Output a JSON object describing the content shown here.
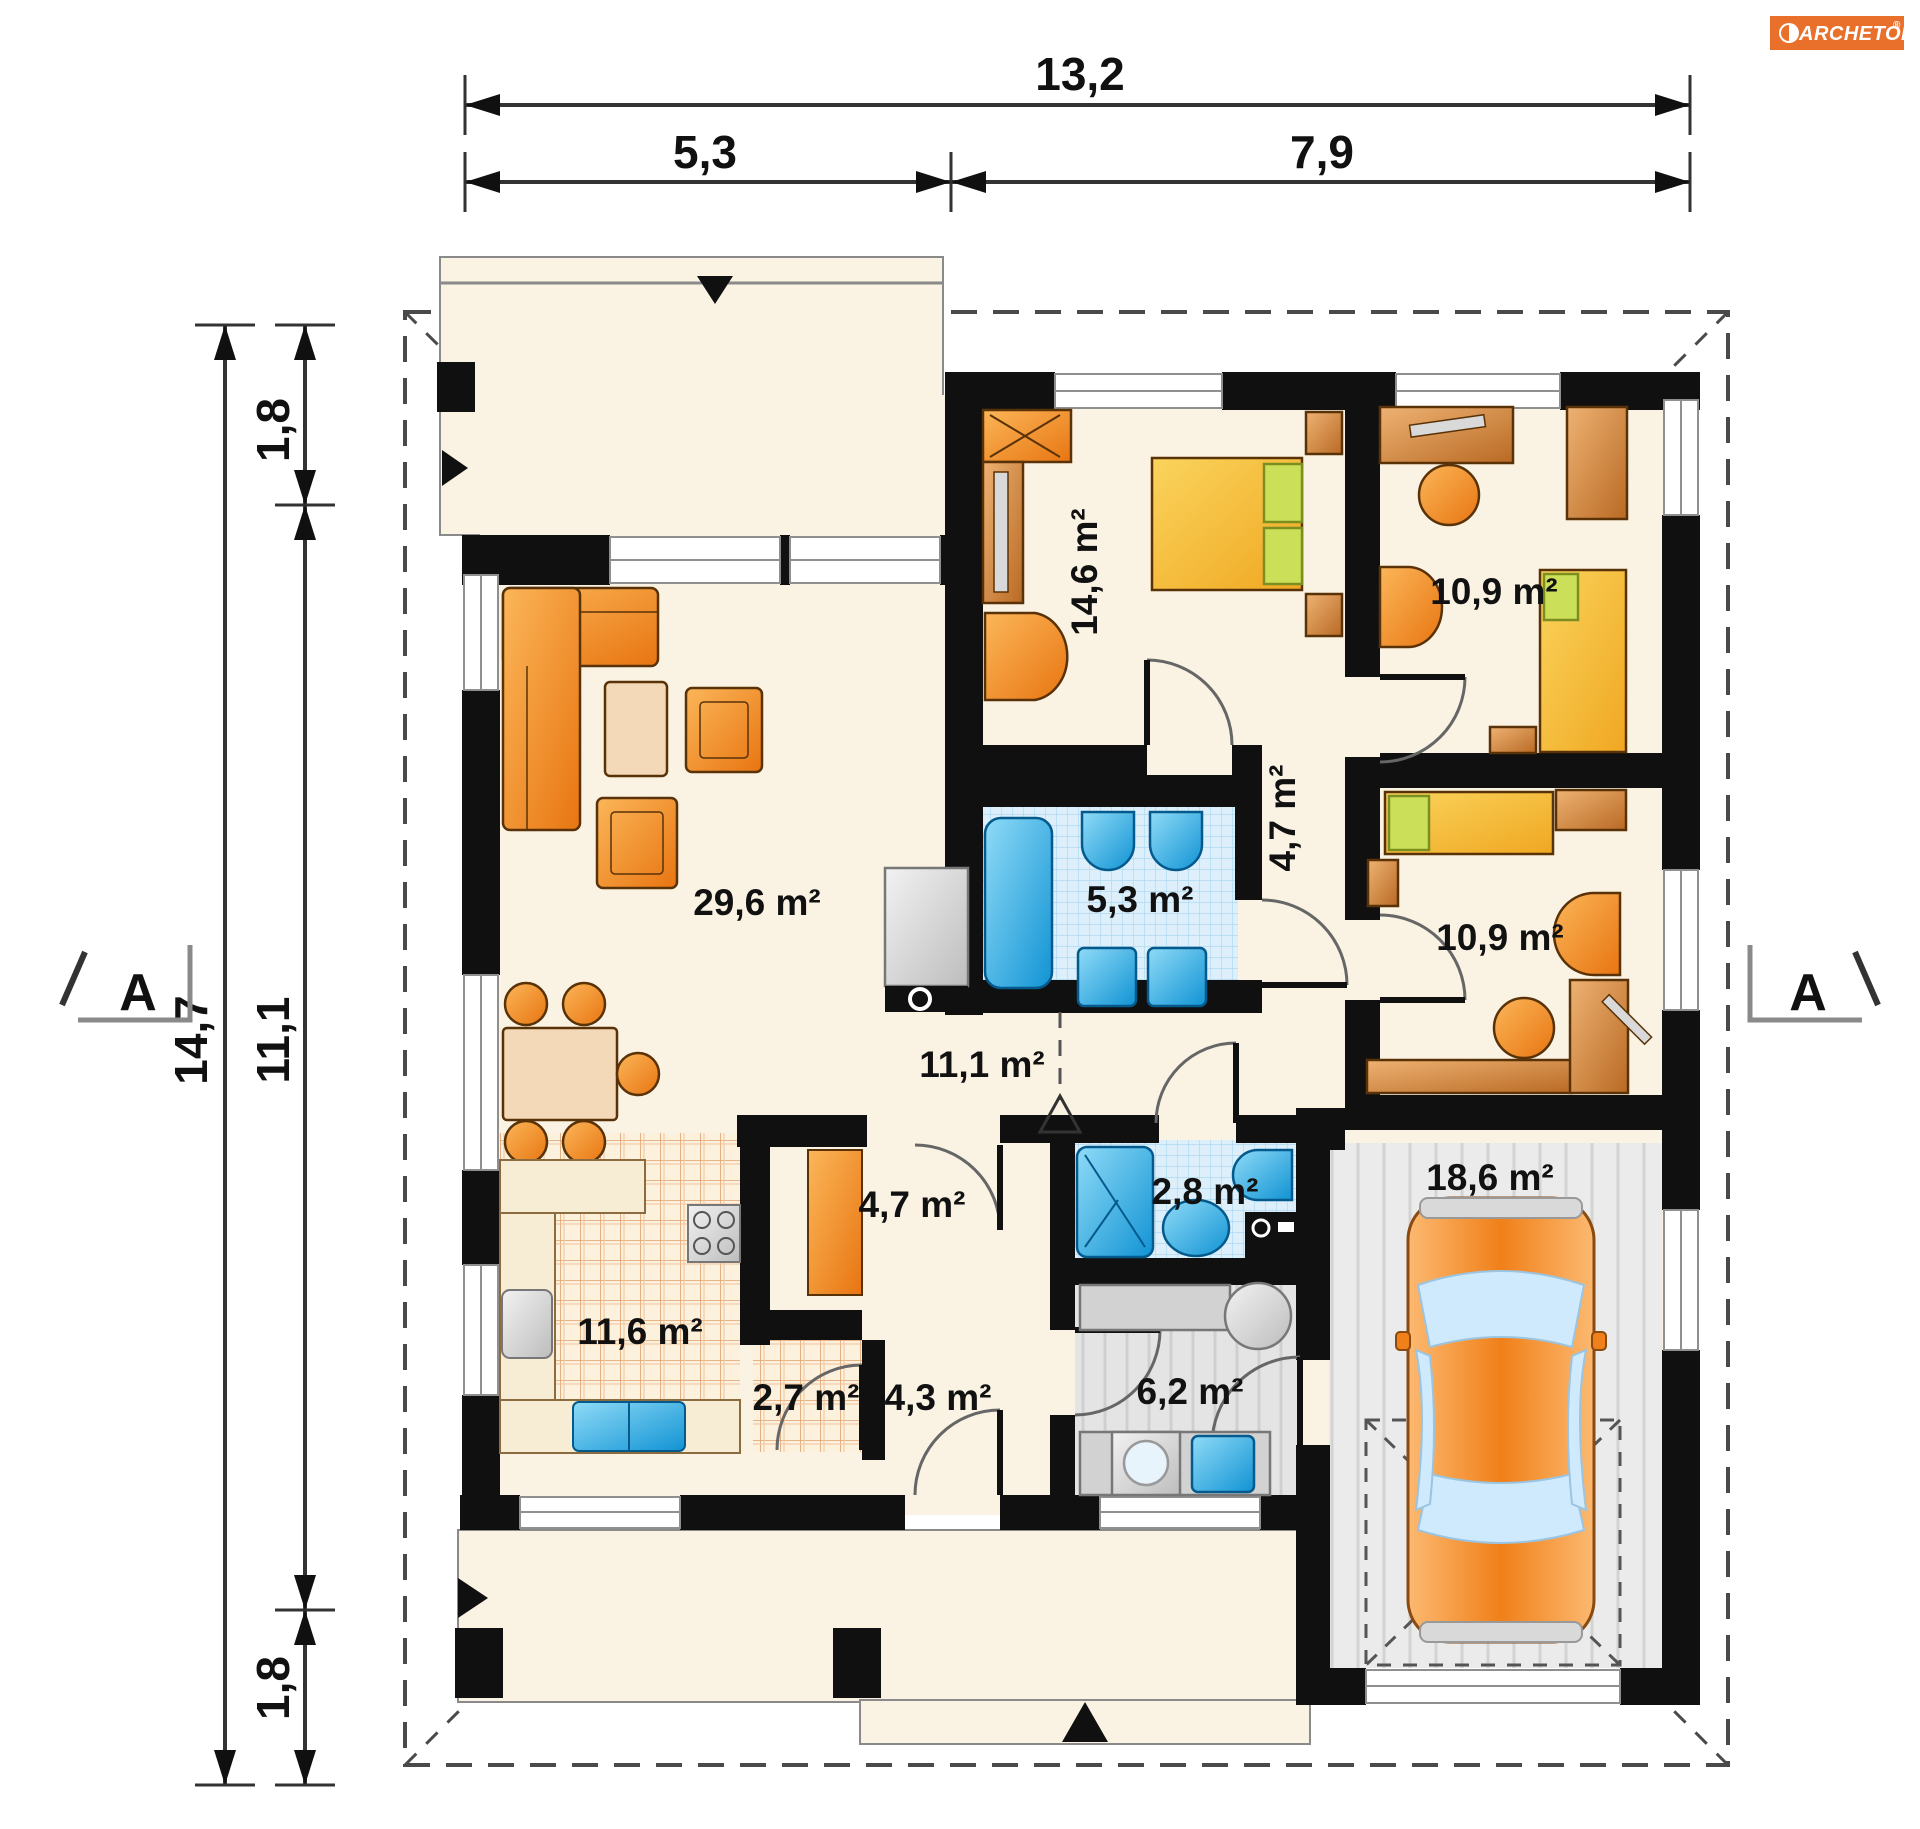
{
  "brand": {
    "name": "ARCHETON",
    "registered": "®"
  },
  "section_markers": {
    "left": "A",
    "right": "A"
  },
  "dimensions": {
    "top_total": "13,2",
    "top_left": "5,3",
    "top_right": "7,9",
    "left_total": "14,7",
    "left_top": "1,8",
    "left_middle": "11,1",
    "left_bottom": "1,8"
  },
  "rooms": {
    "living": {
      "name": "living room",
      "area": "29,6 m²"
    },
    "bedroom": {
      "name": "bedroom",
      "area": "14,6 m²"
    },
    "child_top": {
      "name": "room top right",
      "area": "10,9 m²"
    },
    "corridor_bedrooms": {
      "name": "bedroom corridor",
      "area": "4,7 m²"
    },
    "bath_main": {
      "name": "bathroom",
      "area": "5,3 m²"
    },
    "child_right": {
      "name": "room right",
      "area": "10,9 m²"
    },
    "hall": {
      "name": "hall",
      "area": "11,1 m²"
    },
    "corridor_kitchen": {
      "name": "kitchen corridor",
      "area": "4,7 m²"
    },
    "bath_small": {
      "name": "shower room",
      "area": "2,8 m²"
    },
    "garage": {
      "name": "garage",
      "area": "18,6 m²"
    },
    "kitchen": {
      "name": "kitchen",
      "area": "11,6 m²"
    },
    "pantry": {
      "name": "pantry",
      "area": "2,7 m²"
    },
    "hall_south": {
      "name": "entrance hall",
      "area": "4,3 m²"
    },
    "utility": {
      "name": "utility room",
      "area": "6,2 m²"
    }
  },
  "colors": {
    "wall": "#101010",
    "floor_cream": "#faf3e3",
    "tile_blue": "#ddeffa",
    "furniture_orange": "#f6951f",
    "wood": "#cf8643",
    "garage_gray": "#ebebeb",
    "logo_orange": "#e8702a",
    "fixture_blue": "#2da3dc"
  }
}
